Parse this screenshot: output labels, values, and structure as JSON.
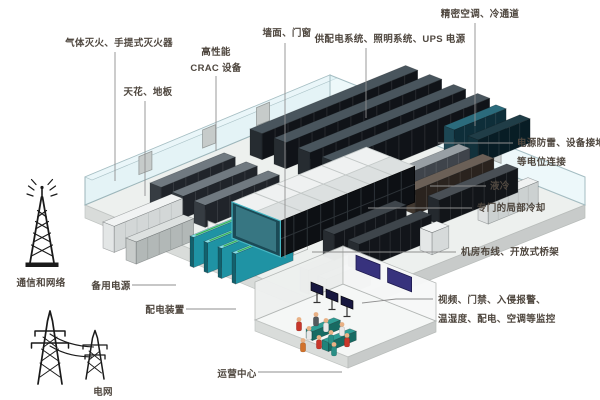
{
  "diagram": {
    "kind": "isometric-datacenter-cutaway",
    "background": "#ffffff"
  },
  "colors": {
    "label_text": "#4f473f",
    "leader_line": "#8f8f8f",
    "wall_glass": "#d7ebef",
    "floor": "#edf0ee",
    "rack_black": "#101318",
    "rack_gray": "#454a4f",
    "cooling_navy": "#0e2e39",
    "generator_teal": "#1f93a4",
    "containment_glass": "#46b7c4",
    "monitor_navy": "#37327d",
    "desk_teal": "#2f9e95",
    "person_red": "#c8372b",
    "person_teal": "#2a8f86",
    "icon_ink": "#1a1a1a"
  },
  "labels": [
    {
      "id": "gas-fire-suppression",
      "lines": [
        "气体灭火、手提式灭火器"
      ],
      "x": 119,
      "y": 46,
      "anchor": "middle",
      "lh": 16,
      "leader": [
        [
          115,
          52
        ],
        [
          115,
          181
        ]
      ]
    },
    {
      "id": "ceiling-floor",
      "lines": [
        "天花、地板"
      ],
      "x": 148,
      "y": 95,
      "anchor": "middle",
      "lh": 16,
      "leader": [
        [
          145,
          101
        ],
        [
          145,
          196
        ]
      ]
    },
    {
      "id": "crac-unit",
      "lines": [
        "高性能",
        "CRAC 设备"
      ],
      "x": 216,
      "y": 55,
      "anchor": "middle",
      "lh": 16,
      "leader": [
        [
          216,
          76
        ],
        [
          216,
          151
        ]
      ]
    },
    {
      "id": "walls-doors-windows",
      "lines": [
        "墙面、门窗"
      ],
      "x": 287,
      "y": 36,
      "anchor": "middle",
      "lh": 16,
      "leader": [
        [
          285,
          43
        ],
        [
          285,
          258
        ]
      ]
    },
    {
      "id": "power-lighting-ups",
      "lines": [
        "供配电系统、照明系统、UPS 电源"
      ],
      "x": 390,
      "y": 42,
      "anchor": "middle",
      "lh": 16,
      "leader": [
        [
          366,
          48
        ],
        [
          366,
          118
        ]
      ]
    },
    {
      "id": "precision-ac-cold-aisle",
      "lines": [
        "精密空调、冷通道"
      ],
      "x": 480,
      "y": 17,
      "anchor": "middle",
      "lh": 16,
      "leader": [
        [
          475,
          23
        ],
        [
          475,
          126
        ]
      ]
    },
    {
      "id": "surge-protection-grounding",
      "lines": [
        "电源防雷、设备接地、",
        "等电位连接"
      ],
      "x": 517,
      "y": 146,
      "anchor": "start",
      "lh": 19,
      "leader": [
        [
          513,
          143
        ],
        [
          438,
          143
        ]
      ]
    },
    {
      "id": "liquid-cooling",
      "lines": [
        "液冷"
      ],
      "x": 490,
      "y": 189,
      "anchor": "start",
      "lh": 16,
      "leader": [
        [
          486,
          186
        ],
        [
          430,
          186
        ]
      ]
    },
    {
      "id": "dedicated-local-cooling",
      "lines": [
        "专门的局部冷却"
      ],
      "x": 477,
      "y": 211,
      "anchor": "start",
      "lh": 16,
      "leader": [
        [
          472,
          208
        ],
        [
          368,
          208
        ]
      ]
    },
    {
      "id": "cabling-open-tray",
      "lines": [
        "机房布线、开放式桥架"
      ],
      "x": 461,
      "y": 255,
      "anchor": "start",
      "lh": 16,
      "leader": [
        [
          456,
          252
        ],
        [
          312,
          252
        ]
      ]
    },
    {
      "id": "monitoring-systems",
      "lines": [
        "视频、门禁、入侵报警、",
        "温湿度、配电、空调等监控"
      ],
      "x": 438,
      "y": 303,
      "anchor": "start",
      "lh": 19,
      "leader": [
        [
          433,
          299
        ],
        [
          396,
          299
        ],
        [
          362,
          303
        ]
      ]
    },
    {
      "id": "operations-center",
      "lines": [
        "运营中心"
      ],
      "x": 237,
      "y": 377,
      "anchor": "middle",
      "lh": 16,
      "leader": [
        [
          258,
          372
        ],
        [
          342,
          372
        ]
      ]
    },
    {
      "id": "communication-network",
      "lines": [
        "通信和网络"
      ],
      "x": 41,
      "y": 286,
      "anchor": "middle",
      "lh": 16,
      "leader": []
    },
    {
      "id": "backup-power",
      "lines": [
        "备用电源"
      ],
      "x": 111,
      "y": 289,
      "anchor": "middle",
      "lh": 16,
      "leader": [
        [
          132,
          285
        ],
        [
          176,
          285
        ]
      ]
    },
    {
      "id": "power-distribution",
      "lines": [
        "配电装置"
      ],
      "x": 165,
      "y": 313,
      "anchor": "middle",
      "lh": 16,
      "leader": [
        [
          186,
          309
        ],
        [
          236,
          309
        ]
      ]
    },
    {
      "id": "power-grid",
      "lines": [
        "电网"
      ],
      "x": 103,
      "y": 395,
      "anchor": "middle",
      "lh": 16,
      "leader": []
    }
  ]
}
